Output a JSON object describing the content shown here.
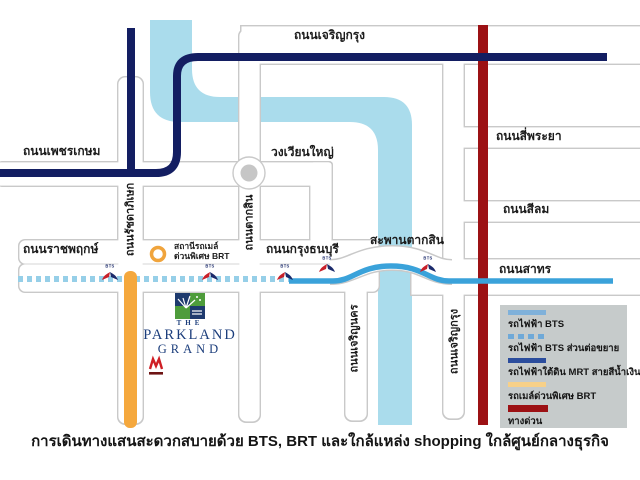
{
  "caption": "การเดินทางแสนสะดวกสบายด้วย BTS, BRT และใกล้แหล่ง shopping ใกล้ศูนย์กลางธุรกิจ",
  "roads": {
    "charoenkrung_top": "ถนนเจริญกรุง",
    "phetkasem": "ถนนเพชรเกษม",
    "wongwianyai": "วงเวียนใหญ่",
    "siphraya": "ถนนสี่พระยา",
    "silom": "ถนนสีลม",
    "ratchaphruek": "ถนนราชพฤกษ์",
    "krungthonburi": "ถนนกรุงธนบุรี",
    "saphan_taksin": "สะพานตากสิน",
    "sathorn": "ถนนสาทร",
    "ratchadaphisek": "ถนนรัชดาภิเษก",
    "taksin": "ถนนตากสิน",
    "charoennakhon": "ถนนเจริญนคร",
    "charoenkrung_side": "ถนนเจริญกรุง"
  },
  "brt_station": {
    "line1": "สถานีรถเมล์",
    "line2": "ด่วนพิเศษ BRT"
  },
  "bts_logo_text": "BTS",
  "logo": {
    "line1": "THE",
    "line2": "PARKLAND",
    "line3": "GRAND"
  },
  "legend": {
    "items": [
      {
        "label": "รถไฟฟ้า BTS",
        "style": "solid",
        "color": "#7fb1da"
      },
      {
        "label": "รถไฟฟ้า BTS ส่วนต่อขยาย",
        "style": "dashed",
        "color": "#6fa9d8"
      },
      {
        "label": "รถไฟฟ้าใต้ดิน MRT สายสีน้ำเงิน",
        "style": "solid",
        "color": "#2b4d9d"
      },
      {
        "label": "รถเมล์ด่วนพิเศษ BRT",
        "style": "solid",
        "color": "#f7d088"
      },
      {
        "label": "ทางด่วน",
        "style": "solid",
        "color": "#9c1114"
      }
    ]
  },
  "colors": {
    "river": "#aadcec",
    "road_border": "#c9c9c9",
    "mrt_line": "#131e62",
    "bts_line": "#3aa2da",
    "bts_extension": "#96cfe8",
    "brt_line": "#f5a83d",
    "expressway": "#9c1114",
    "legend_bg": "#c6cbcb",
    "logo_navy": "#1e3a6e",
    "logo_green": "#4e9c3b"
  }
}
